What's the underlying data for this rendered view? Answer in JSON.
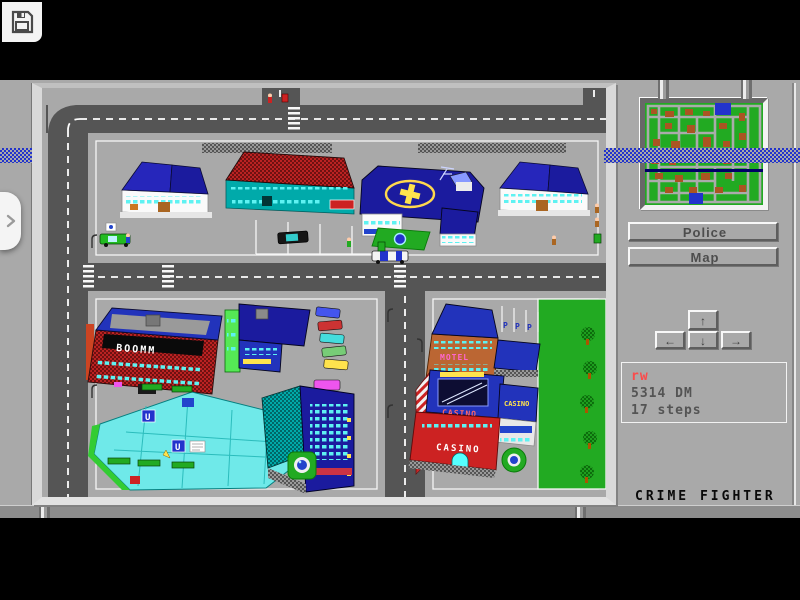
{
  "chrome": {
    "save_icon": "floppy-disk",
    "expand_icon": "chevron-right"
  },
  "game": {
    "title": "CRIME FIGHTER",
    "panel": {
      "buttons": [
        {
          "label": "Police"
        },
        {
          "label": "Map"
        }
      ],
      "dpad": {
        "up": "↑",
        "left": "←",
        "down": "↓",
        "right": "→"
      },
      "status": {
        "player": "rw",
        "money": "5314 DM",
        "steps": "17 steps"
      }
    },
    "map": {
      "signs": {
        "disco": "BOOMM",
        "motel": "MOTEL",
        "casino_roof": "CASINO",
        "casino_annex": "CASINO",
        "casino_wall": "CASINO",
        "parking_spots": [
          "P",
          "P",
          "P"
        ],
        "mall_logo": "U"
      }
    },
    "colors": {
      "desktop": "#a9a9a9",
      "road": "#555555",
      "stripe_blue": "#2233cc",
      "accent_red": "#fb4b4b",
      "text_dark": "#545454",
      "minimap_green": "#22aa22",
      "minimap_building": "#aa5522"
    }
  }
}
